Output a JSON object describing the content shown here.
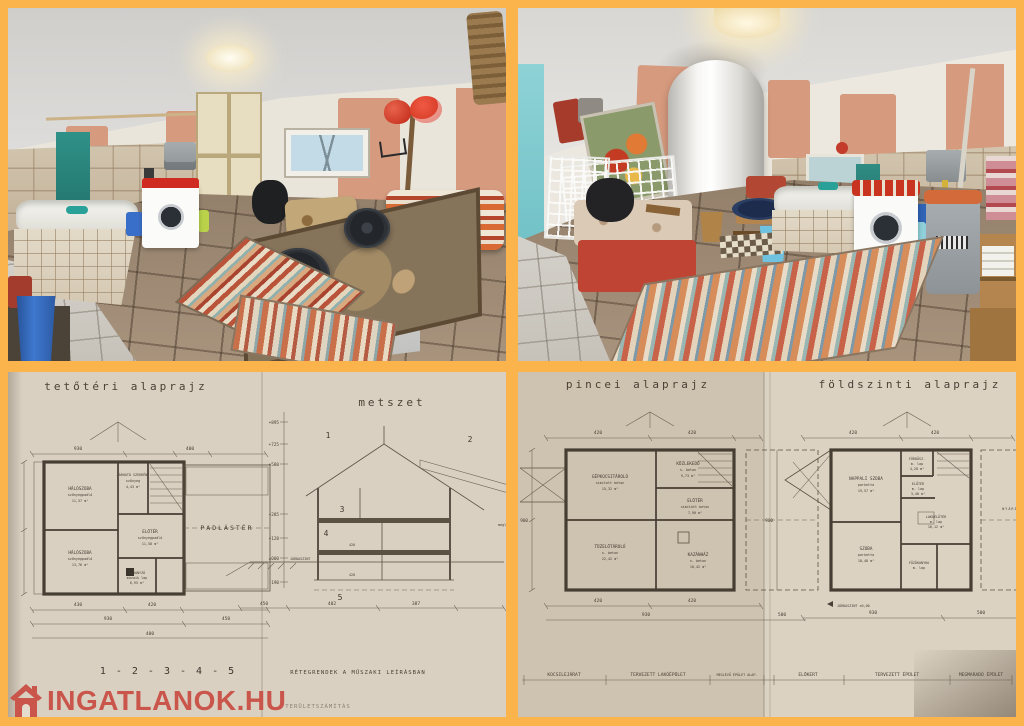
{
  "page": {
    "background_color": "#FBB34C"
  },
  "watermark": {
    "brand": "INGATLANOK.HU",
    "color": "#C9544A"
  },
  "photos": {
    "top_left": {
      "alt": "Alagsori helyiség káddal, mosógéppel és csempézett padlóval"
    },
    "top_right": {
      "alt": "Alagsori helyiség villanybojlerrel, mosógéppel és rongyszőnyeggel"
    }
  },
  "plans": {
    "attic": {
      "title": "tetőtéri alaprajz",
      "rooms": [
        {
          "name": "HÁLÓSZOBA",
          "floor": "szőnyegpadló",
          "area": "11,57 m²"
        },
        {
          "name": "JÁRHATÓ SZEKRÉNY",
          "floor": "szőnyeg",
          "area": "4,43 m²"
        },
        {
          "name": "HÁLÓSZOBA",
          "floor": "szőnyegpadló",
          "area": "13,76 m²"
        },
        {
          "name": "ELŐTÉR",
          "floor": "szőnyegpadló",
          "area": "11,58 m²"
        },
        {
          "name": "ZUHANYZÓ",
          "floor": "mozaik lap",
          "area": "6,95 m²"
        },
        {
          "name": "PADLÁSTÉR",
          "floor": "",
          "area": ""
        }
      ],
      "dims": {
        "top": "930",
        "top2": "400",
        "bottom1_a": "430",
        "bottom1_b": "420",
        "bottom2_a": "930",
        "bottom2_b": "450",
        "bottom3": "400"
      }
    },
    "section": {
      "title": "metszet",
      "levels": [
        "+895",
        "+725",
        "+580",
        "+285",
        "+128",
        "±000",
        "-190"
      ],
      "level_note": "JÁRDASZINT",
      "marks": [
        "1",
        "2",
        "3",
        "4",
        "5"
      ],
      "dims": [
        "450",
        "402",
        "387"
      ],
      "inner_dims": [
        "420",
        "420"
      ],
      "layer_numbers": "1 - 2 - 3 - 4 - 5",
      "layer_note": "RÉTEGRENDEK A MŰSZAKI LEÍRÁSBAN",
      "existing_note": "meglévő épület"
    },
    "basement": {
      "title": "pincei alaprajz",
      "rooms": [
        {
          "name": "GÉPKOCSITÁROLÓ",
          "floor": "simított beton",
          "area": "15,32 m²"
        },
        {
          "name": "KÖZLEKEDŐ",
          "floor": "s. beton",
          "area": "9,73 m²"
        },
        {
          "name": "ELŐTÉR",
          "floor": "simított beton",
          "area": "7,90 m²"
        },
        {
          "name": "TÜZELŐTÁROLÓ",
          "floor": "s. beton",
          "area": "22,42 m²"
        },
        {
          "name": "KAZÁNHÁZ",
          "floor": "s. beton",
          "area": "10,42 m²"
        }
      ],
      "strip": [
        "KOCSILEJÁRAT",
        "TERVEZETT LAKÓÉPÜLET",
        "MEGLÉVŐ ÉPÜLET ALAP."
      ],
      "dims": {
        "top_a": "420",
        "top_b": "420",
        "bottom_a": "930",
        "bottom_b": "500",
        "left": "900"
      }
    },
    "ground": {
      "title": "földszinti alaprajz",
      "rooms": [
        {
          "name": "NAPPALI SZOBA",
          "floor": "parketta",
          "area": "19,57 m²"
        },
        {
          "name": "SZOBA",
          "floor": "parketta",
          "area": "18,48 m²"
        },
        {
          "name": "FÜRDŐSZ.",
          "floor": "m. lap",
          "area": "4,28 m²"
        },
        {
          "name": "ELŐTÉR",
          "floor": "m. lap",
          "area": "3,40 m²"
        },
        {
          "name": "LAKÓELŐTÉR",
          "floor": "m. lap",
          "area": "16,12 m²"
        },
        {
          "name": "FŐZŐKONYHA",
          "floor": "m. lap",
          "area": ""
        },
        {
          "name": "NYÁRIKONYHA",
          "floor": "",
          "area": ""
        }
      ],
      "level_note": "JÁRDASZINT ±0,00",
      "strip": [
        "ELŐKERT",
        "TERVEZETT ÉPÜLET",
        "MEGMARADÓ ÉPÜLET"
      ],
      "dims": {
        "top_a": "420",
        "top_b": "420",
        "bottom_a": "930",
        "bottom_b": "500",
        "left": "900"
      }
    },
    "footer_note": "TERÜLETSZÁMÍTÁS"
  }
}
